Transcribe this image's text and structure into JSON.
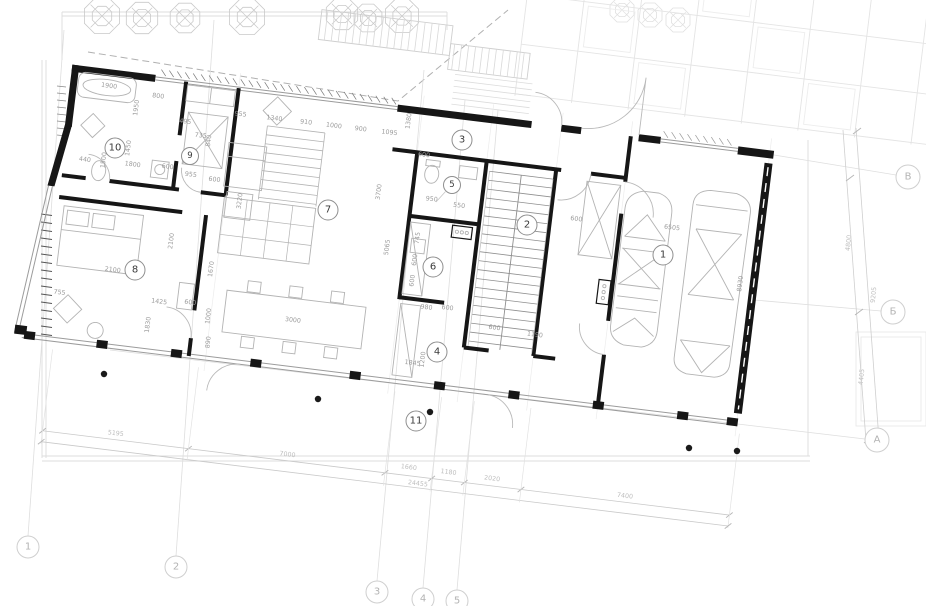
{
  "drawing": {
    "kind": "architectural ground-floor plan",
    "rooms": [
      {
        "number": "1"
      },
      {
        "number": "2"
      },
      {
        "number": "3"
      },
      {
        "number": "4"
      },
      {
        "number": "5"
      },
      {
        "number": "6"
      },
      {
        "number": "7"
      },
      {
        "number": "8"
      },
      {
        "number": "9"
      },
      {
        "number": "10"
      },
      {
        "number": "11"
      }
    ],
    "grid_axes": {
      "bottom": [
        "1",
        "2",
        "3",
        "4",
        "5"
      ],
      "right_top_to_bottom": [
        "В",
        "Б",
        "А"
      ]
    },
    "colors": {
      "wall": "#161616",
      "thin_line": "#9b9b9b",
      "furniture": "#b3b3b3",
      "site_line": "#d9d9d9",
      "dim_text": "#9b9b9b",
      "grid_text": "#b3b3b3",
      "room_text": "#3a3a3a"
    },
    "dimensions": {
      "interior": [
        {
          "t": "1900",
          "x": 36,
          "y": 14,
          "o": "h"
        },
        {
          "t": "800",
          "x": 86,
          "y": 18,
          "o": "h"
        },
        {
          "t": "1950",
          "x": 66,
          "y": 32,
          "o": "v"
        },
        {
          "t": "495",
          "x": 116,
          "y": 40,
          "o": "h"
        },
        {
          "t": "735",
          "x": 133,
          "y": 52,
          "o": "h"
        },
        {
          "t": "1450",
          "x": 63,
          "y": 73,
          "o": "v"
        },
        {
          "t": "1800",
          "x": 69,
          "y": 89,
          "o": "h"
        },
        {
          "t": "600",
          "x": 104,
          "y": 87,
          "o": "h"
        },
        {
          "t": "440",
          "x": 21,
          "y": 90,
          "o": "h"
        },
        {
          "t": "950",
          "x": 125,
          "y": 70,
          "o": "v"
        },
        {
          "t": "955",
          "x": 128,
          "y": 92,
          "o": "h"
        },
        {
          "t": "600",
          "x": 152,
          "y": 94,
          "o": "h"
        },
        {
          "t": "1500",
          "x": 40,
          "y": 88,
          "o": "v"
        },
        {
          "t": "840",
          "x": 142,
          "y": 56,
          "o": "v"
        },
        {
          "t": "955",
          "x": 170,
          "y": 26,
          "o": "h"
        },
        {
          "t": "1340",
          "x": 204,
          "y": 26,
          "o": "h"
        },
        {
          "t": "910",
          "x": 236,
          "y": 26,
          "o": "h"
        },
        {
          "t": "1000",
          "x": 264,
          "y": 26,
          "o": "h"
        },
        {
          "t": "900",
          "x": 291,
          "y": 26,
          "o": "h"
        },
        {
          "t": "1095",
          "x": 320,
          "y": 26,
          "o": "h"
        },
        {
          "t": "1380",
          "x": 338,
          "y": 12,
          "o": "v"
        },
        {
          "t": "3220",
          "x": 180,
          "y": 112,
          "o": "v"
        },
        {
          "t": "3700",
          "x": 317,
          "y": 86,
          "o": "v"
        },
        {
          "t": "5065",
          "x": 332,
          "y": 140,
          "o": "v"
        },
        {
          "t": "1670",
          "x": 160,
          "y": 183,
          "o": "v"
        },
        {
          "t": "1000",
          "x": 163,
          "y": 230,
          "o": "v"
        },
        {
          "t": "890",
          "x": 166,
          "y": 256,
          "o": "v"
        },
        {
          "t": "2100",
          "x": 117,
          "y": 160,
          "o": "v"
        },
        {
          "t": "2100",
          "x": 62,
          "y": 196,
          "o": "h"
        },
        {
          "t": "755",
          "x": 12,
          "y": 225,
          "o": "h"
        },
        {
          "t": "1425",
          "x": 112,
          "y": 222,
          "o": "h"
        },
        {
          "t": "600",
          "x": 143,
          "y": 219,
          "o": "h"
        },
        {
          "t": "1830",
          "x": 104,
          "y": 246,
          "o": "v"
        },
        {
          "t": "3000",
          "x": 247,
          "y": 224,
          "o": "h"
        },
        {
          "t": "1845",
          "x": 371,
          "y": 252,
          "o": "h"
        },
        {
          "t": "950",
          "x": 370,
          "y": 87,
          "o": "h"
        },
        {
          "t": "550",
          "x": 398,
          "y": 90,
          "o": "h"
        },
        {
          "t": "600",
          "x": 357,
          "y": 44,
          "o": "h"
        },
        {
          "t": "745",
          "x": 361,
          "y": 127,
          "o": "v"
        },
        {
          "t": "600",
          "x": 361,
          "y": 149,
          "o": "v"
        },
        {
          "t": "600",
          "x": 361,
          "y": 170,
          "o": "v"
        },
        {
          "t": "980",
          "x": 378,
          "y": 195,
          "o": "h"
        },
        {
          "t": "600",
          "x": 399,
          "y": 193,
          "o": "h"
        },
        {
          "t": "1200",
          "x": 381,
          "y": 247,
          "o": "v"
        },
        {
          "t": "600",
          "x": 448,
          "y": 207,
          "o": "h"
        },
        {
          "t": "1190",
          "x": 489,
          "y": 209,
          "o": "h"
        },
        {
          "t": "600",
          "x": 516,
          "y": 89,
          "o": "h"
        },
        {
          "t": "6505",
          "x": 612,
          "y": 86,
          "o": "h"
        },
        {
          "t": "8930",
          "x": 687,
          "y": 133,
          "o": "v"
        }
      ],
      "site_chain": [
        {
          "t": "5195",
          "x": 85,
          "y": 358,
          "o": "h"
        },
        {
          "t": "7000",
          "x": 258,
          "y": 358,
          "o": "h"
        },
        {
          "t": "1660",
          "x": 380,
          "y": 356,
          "o": "h"
        },
        {
          "t": "1180",
          "x": 420,
          "y": 356,
          "o": "h"
        },
        {
          "t": "2020",
          "x": 464,
          "y": 357,
          "o": "h"
        },
        {
          "t": "7400",
          "x": 598,
          "y": 358,
          "o": "h"
        }
      ],
      "site_total": {
        "t": "24455",
        "x": 391,
        "y": 371,
        "o": "h"
      },
      "right_chain": [
        {
          "t": "4800",
          "x": 849,
          "y": 243
        },
        {
          "t": "4405",
          "x": 862,
          "y": 377
        }
      ],
      "right_total": {
        "t": "9205",
        "x": 874,
        "y": 295
      }
    }
  }
}
